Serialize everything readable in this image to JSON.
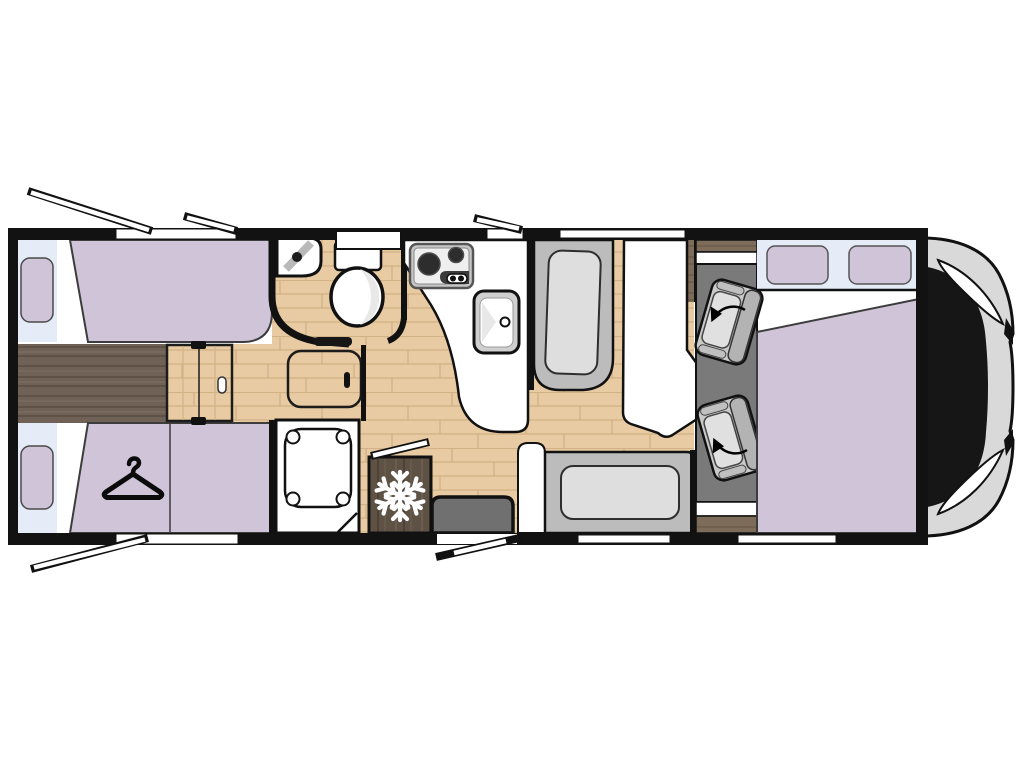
{
  "meta": {
    "type": "motorhome-floorplan",
    "description": "Top-down floor plan of a coachbuilt motorhome: rear twin single beds, central bathroom with shower, kitchen with two-burner hob and sink, fridge, face-to-face lounge with table, two swivel cab seats, drop-down over-cab double bed, vehicle cab at front right"
  },
  "colors": {
    "canvas": "#ffffff",
    "wall": "#121212",
    "outline": "#1c1c1c",
    "bed": "#d0c4d8",
    "bed_outline": "#3c3c3c",
    "window_band": "#e6ebf8",
    "wood": "#e8cba2",
    "wood_line": "#d2b286",
    "wood_dark": "#6f6156",
    "wood_dark_line": "#594c41",
    "wood_dark_hi": "#7e6f60",
    "wood_cab": "#7d6c5a",
    "wood_cab_line": "#695847",
    "fridge_wood": "#5e5245",
    "fridge_wood_line": "#6f6153",
    "fridge_wood_dark": "#4e4236",
    "bench": "#bcbcbc",
    "cushion": "#dedede",
    "cab_floor": "#7a7a7a",
    "cab_seat": "#c9c9c9",
    "cab_seat_hi": "#e0e0e0",
    "cab_seat_mid": "#b3b3b3",
    "cab_body": "#d9d9d9",
    "windshield": "#161616",
    "step": "#707070",
    "white": "#ffffff",
    "stove_frame": "#c6c6c6",
    "stove_panel": "#efefef",
    "burner": "#2d2d2d",
    "knob_panel": "#3b3b3b",
    "sink_frame": "#cfcfcf",
    "shade": "#e8e8e8",
    "sink_stripe": "#b9b9b9"
  },
  "icons": {
    "snowflake": "snowflake-icon (fridge)",
    "hanger": "hanger-icon (wardrobe under rear bed)",
    "swivel_arrow": "curved-arrow-icon (rotating cab seats)"
  },
  "inventory": {
    "rear_bedroom": {
      "single_beds": 2,
      "pillows": 2,
      "wardrobe_with_hanger": 1,
      "center_step": 1,
      "sliding_door": 1
    },
    "bathroom": {
      "corner_sink": 1,
      "toilet": 1,
      "shower_tray": 1,
      "floor_hatch": 1
    },
    "kitchen": {
      "hob_burners": 2,
      "sink": 1,
      "fridge_with_snowflake": 1
    },
    "lounge": {
      "bench_seats": 2,
      "table": 1,
      "entry_step": 1
    },
    "cab": {
      "swivel_seats": 2,
      "drop_down_bed": 1,
      "bed_pillows": 2,
      "windshield": 1,
      "headlights": 2
    },
    "openings": {
      "open_awning_windows": 4,
      "open_entry_door": 1,
      "window_slits_in_wall": 6
    }
  }
}
